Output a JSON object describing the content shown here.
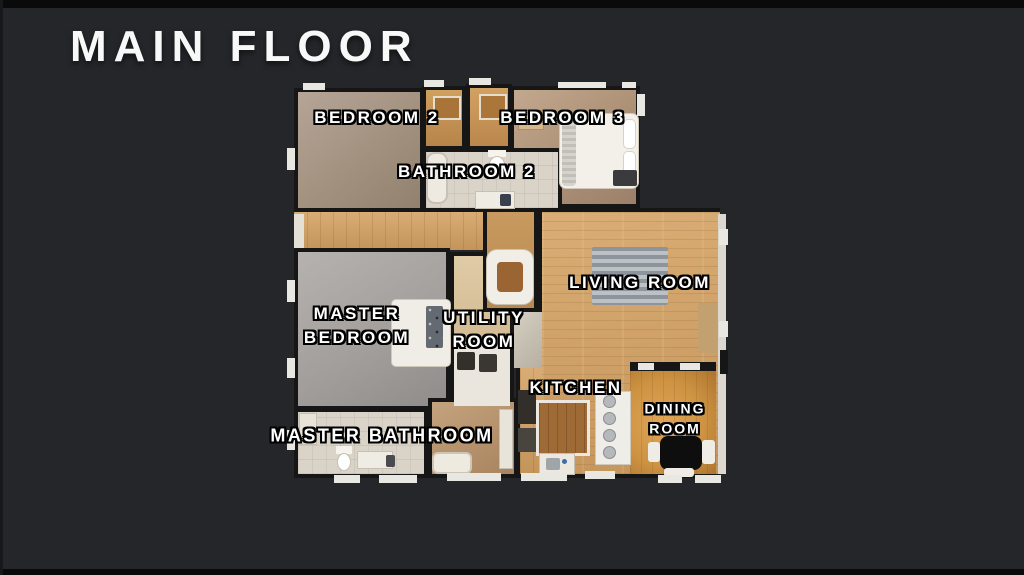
{
  "title": "MAIN FLOOR",
  "rooms": {
    "bedroom2": {
      "label": "BEDROOM 2"
    },
    "bedroom3": {
      "label": "BEDROOM 3"
    },
    "bathroom2": {
      "label": "BATHROOM 2"
    },
    "master_bedroom": {
      "line1": "MASTER",
      "line2": "BEDROOM"
    },
    "utility_room": {
      "line1": "UTILITY",
      "line2": "ROOM"
    },
    "living_room": {
      "label": "LIVING ROOM"
    },
    "kitchen": {
      "label": "KITCHEN"
    },
    "dining_room": {
      "line1": "DINING",
      "line2": "ROOM"
    },
    "master_bathroom": {
      "label": "MASTER BATHROOM"
    }
  },
  "colors": {
    "background": "#24262a",
    "letterbox": "#0a0a0b",
    "wall": "#161616",
    "label_text": "#ffffff",
    "label_outline": "#000000",
    "wood_floor": "#cda166",
    "dining_wood": "#c9913f",
    "master_carpet": "#a4a09d",
    "bedroom_carpet": "#a89888",
    "closet_floor": "#c3924f",
    "bathroom_tile": "#d9d3c8",
    "furniture_white": "#efece6",
    "dining_table": "#0e0e0e"
  }
}
